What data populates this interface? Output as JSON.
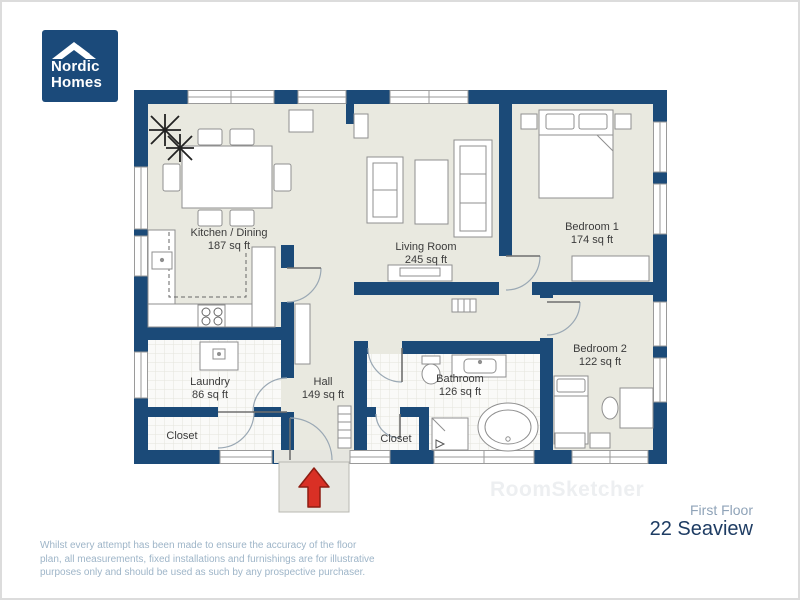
{
  "logo": {
    "line1": "Nordic",
    "line2": "Homes"
  },
  "plan": {
    "rooms": [
      {
        "name": "Kitchen / Dining",
        "area": "187 sq ft"
      },
      {
        "name": "Living Room",
        "area": "245 sq ft"
      },
      {
        "name": "Bedroom 1",
        "area": "174 sq ft"
      },
      {
        "name": "Bedroom 2",
        "area": "122 sq ft"
      },
      {
        "name": "Laundry",
        "area": "86 sq ft"
      },
      {
        "name": "Hall",
        "area": "149 sq ft"
      },
      {
        "name": "Bathroom",
        "area": "126 sq ft"
      },
      {
        "name": "Closet",
        "area": ""
      },
      {
        "name": "Closet",
        "area": ""
      }
    ],
    "colors": {
      "wall_navy": "#1b4a78",
      "floor": "#e9e9e0",
      "tile": "#fafaf8",
      "entrance_arrow_red": "#d93025"
    }
  },
  "watermark": {
    "text": "RoomSketcher"
  },
  "footer": {
    "disclaimer": "Whilst every attempt has been made to ensure the accuracy of the floor plan, all measurements, fixed installations and furnishings are for illustrative purposes only and should be used as such by any prospective purchaser.",
    "floor_label": "First Floor",
    "address": "22 Seaview"
  }
}
